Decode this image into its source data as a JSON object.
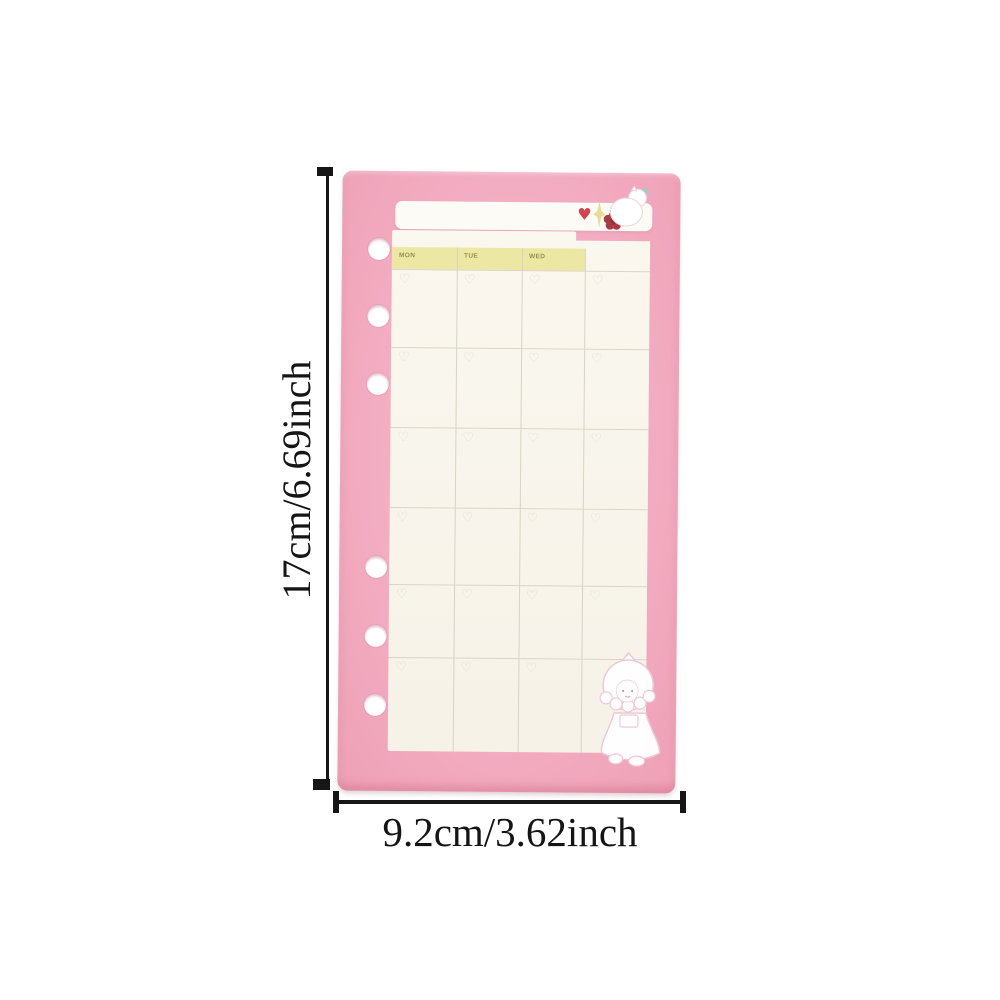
{
  "product_photo": {
    "type": "planner-refill-page-photo",
    "vertical_dimension_label": "17cm/6.69inch",
    "horizontal_dimension_label": "9.2cm/3.62inch",
    "card_color": "#f3adc2",
    "binder_holes": 6,
    "calendar": {
      "day_headers": [
        "MON",
        "TUE",
        "WED"
      ],
      "columns": 4,
      "rows": 6,
      "header_color": "#ece7a3",
      "sheet_color": "#f9f5ec",
      "grid_line_color": "#d8d3c2",
      "cell_heart_glyph": "♡"
    },
    "decorations": {
      "banner_heart_glyph": "♥",
      "banner_heart_color": "#d24450",
      "flower_color": "#a83b43",
      "sparkle_color": "#e8dc96",
      "teal_accent_color": "#93d2c6",
      "top_right": "white-cat-with-teal-accent",
      "bottom_right": "white-girl-in-bonnet"
    }
  }
}
